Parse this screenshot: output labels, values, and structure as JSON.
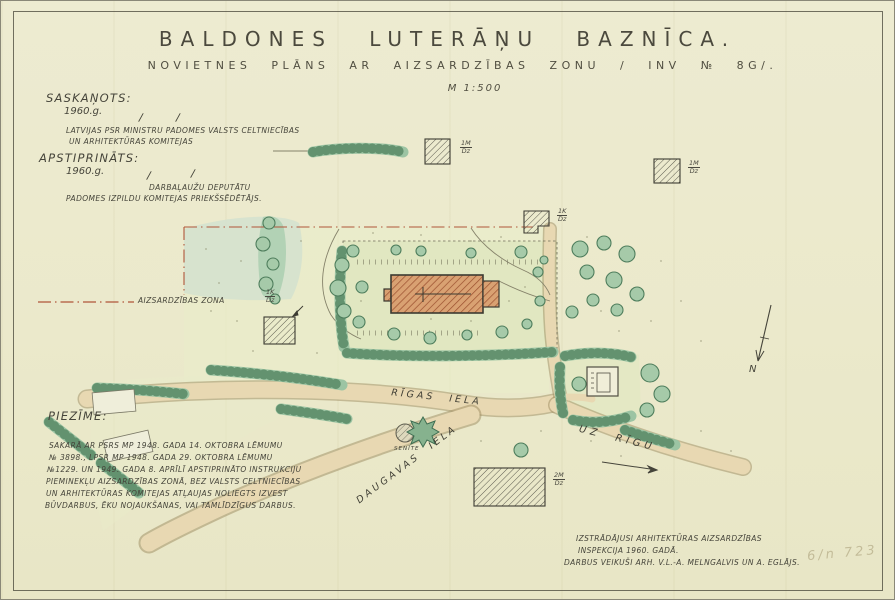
{
  "sheet": {
    "title": "BALDONES LUTERĀŅU BAZNĪCA.",
    "subtitle": "NOVIETNES PLĀNS AR AIZSARDZĪBAS ZONU / INV № 8G/.",
    "scale": "M 1:500",
    "pencil_note": "6/n 723"
  },
  "approvals": {
    "saskanots_label": "SASKAŅOTS:",
    "saskanots_year": "1960.g.",
    "saskanots_body_line1": "LATVIJAS PSR MINISTRU PADOMES VALSTS CELTNIECĪBAS",
    "saskanots_body_line2": "UN ARHITEKTŪRAS KOMITEJAS",
    "apstiprinats_label": "APSTIPRINĀTS:",
    "apstiprinats_year": "1960.g.",
    "apstiprinats_body_line1": "DARBAĻAUŽU DEPUTĀTU",
    "apstiprinats_body_line2": "PADOMES IZPILDU KOMITEJAS PRIEKŠSĒDĒTĀJS.",
    "sign_mark": "/"
  },
  "legend": {
    "zone_label": "AIZSARDZĪBAS ZONA"
  },
  "note": {
    "heading": "PIEZĪME:",
    "lines": [
      "SAKARĀ AR PSRS MP 1948. GADA 14. OKTOBRA LĒMUMU",
      "№ 3898., LPSR MP 1948. GADA 29. OKTOBRA LĒMUMU",
      "№1229. UN 1949. GADA 8. APRĪLĪ APSTIPRINĀTO INSTRUKCIJU",
      "PIEMINEKĻU AIZSARDZĪBAS ZONĀ, BEZ VALSTS CELTNIECĪBAS",
      "UN ARHITEKTŪRAS KOMITEJAS ATĻAUJAS NOLIEGTS IZVEST",
      "BŪVDARBUS, ĒKU NOJAUKŠANAS, VAI TAMLĪDZĪGUS DARBUS."
    ]
  },
  "credits": {
    "line1": "IZSTRĀDĀJUSI ARHITEKTŪRAS AIZSARDZĪBAS",
    "line2": "INSPEKCIJA 1960. GADĀ.",
    "line3": "DARBUS VEIKUŠI ARH. V.L.-A. MELNGALVIS UN A. EGLĀJS."
  },
  "map": {
    "north_label": "N",
    "streets": {
      "rigas": "RĪGAS IELA",
      "daugavas": "DAUGAVAS IELA",
      "uz_rigu": "UZ RĪGU",
      "senite": "SENĪTE"
    },
    "buildings": [
      {
        "num": "1M",
        "den": "Dz"
      },
      {
        "num": "1M",
        "den": "Dz"
      },
      {
        "num": "1K",
        "den": "Dz"
      },
      {
        "num": "1K",
        "den": "Dz"
      },
      {
        "num": "2M",
        "den": "Dz"
      }
    ],
    "colors": {
      "paper": "#ebe9cb",
      "zone_line": "#b0563a",
      "tree_fill": "#a6caa9",
      "tree_stroke": "#4e7d5c",
      "church_fill": "#d9a172",
      "church_hatch": "#9a4f2e",
      "road_fill": "#e8d8b2",
      "ink": "#45443a"
    }
  }
}
